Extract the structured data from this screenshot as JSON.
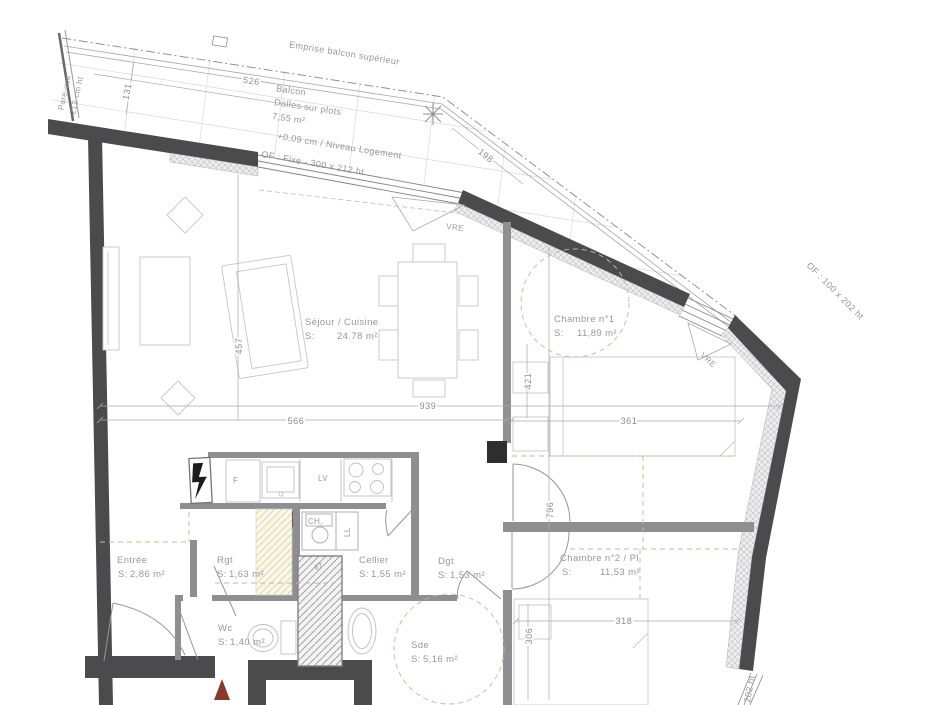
{
  "balcony": {
    "emprise": "Emprise balcon supérieur",
    "name": "Balcon",
    "floor": "Dalles sur plots",
    "area": "7,55 m²",
    "level": "+0.09 cm / Niveau Logement",
    "window": "OF : Fixe - 300 x 212 ht",
    "pare_vue_1": "Pare-vue",
    "pare_vue_2": "212 cm ht",
    "dim_width": "526",
    "dim_depth": "131",
    "dim_edge": "198"
  },
  "rooms": {
    "sejour": {
      "name": "Séjour / Cuisine",
      "s": "S:",
      "area": "24.78 m²"
    },
    "chambre1": {
      "name": "Chambre n°1",
      "s": "S:",
      "area": "11,89 m²"
    },
    "chambre2": {
      "name": "Chambre n°2 / Pl",
      "s": "S:",
      "area": "11,53 m²"
    },
    "entree": {
      "name": "Entrée",
      "s": "S:",
      "area": "2,86 m²"
    },
    "rgt": {
      "name": "Rgt",
      "s": "S:",
      "area": "1,63 m²"
    },
    "cellier": {
      "name": "Cellier",
      "s": "S:",
      "area": "1,55 m²"
    },
    "dgt": {
      "name": "Dgt",
      "s": "S:",
      "area": "1,53 m²"
    },
    "wc": {
      "name": "Wc",
      "s": "S:",
      "area": "1,40 m²"
    },
    "sde": {
      "name": "Sde",
      "s": "S:",
      "area": "5,16 m²"
    }
  },
  "openings": {
    "window_chambre1": "OF : 100 x 202 ht",
    "window_bottom_right": "202 ht",
    "vre_sejour": "VRE",
    "vre_chambre1": "VRE"
  },
  "appliances": {
    "fridge": "F",
    "dishwasher": "LV",
    "boiler": "CH.",
    "washing_machine": "LL"
  },
  "dims": {
    "d939": "939",
    "d566": "566",
    "d457": "457",
    "d421": "421",
    "d361": "361",
    "d796": "796",
    "d318": "318",
    "d306": "306",
    "d67": "67"
  },
  "colors": {
    "exterior_wall": "#4b4b4e",
    "interior_wall": "#8f8f91",
    "entrance_arrow": "#8a3a2c",
    "dashed_zone": "#d3b48f"
  }
}
